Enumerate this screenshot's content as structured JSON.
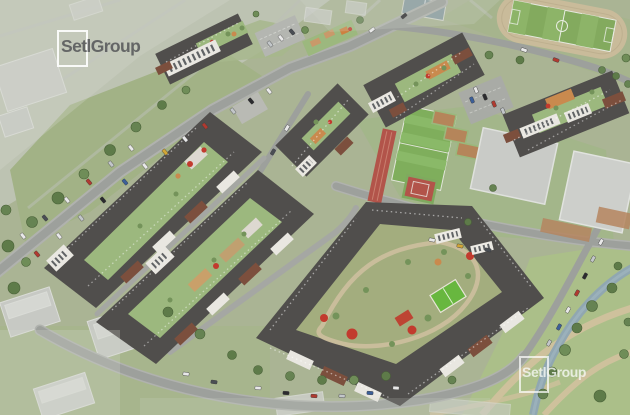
{
  "watermarks": {
    "top_left": {
      "label": "SetlGroup",
      "icon": "square-frame-icon"
    },
    "bottom_right": {
      "label": "SetlGroup",
      "icon": "square-frame-icon"
    }
  },
  "scene": {
    "palette": {
      "grass_base": "#aab494",
      "grass_bright": "#9cb87e",
      "road_gray": "#9da09c",
      "roof_dark": "#504e4c",
      "brick_red": "#7c4f3d",
      "facade_white": "#e9e7e1",
      "playground_orange": "#c98a4e",
      "playground_red": "#c23b2e",
      "minipitch_green": "#68b73f",
      "stadium_track_tan": "#c9bb9a",
      "stadium_field_green": "#83aa5e",
      "sport_track_red": "#b2544a",
      "school_roof_gray": "#c9cbc7",
      "park_path_tan": "#cec19c",
      "stream_blue_gray": "#8ea5b3",
      "tree_green": "#5e7b49",
      "ghost_building_gray": "#c7c9c4",
      "car_colors": [
        "#e8e8e8",
        "#2b2b2e",
        "#b03a30",
        "#3c5f99",
        "#c2c6c9",
        "#d2a636",
        "#4a4e54"
      ]
    }
  }
}
